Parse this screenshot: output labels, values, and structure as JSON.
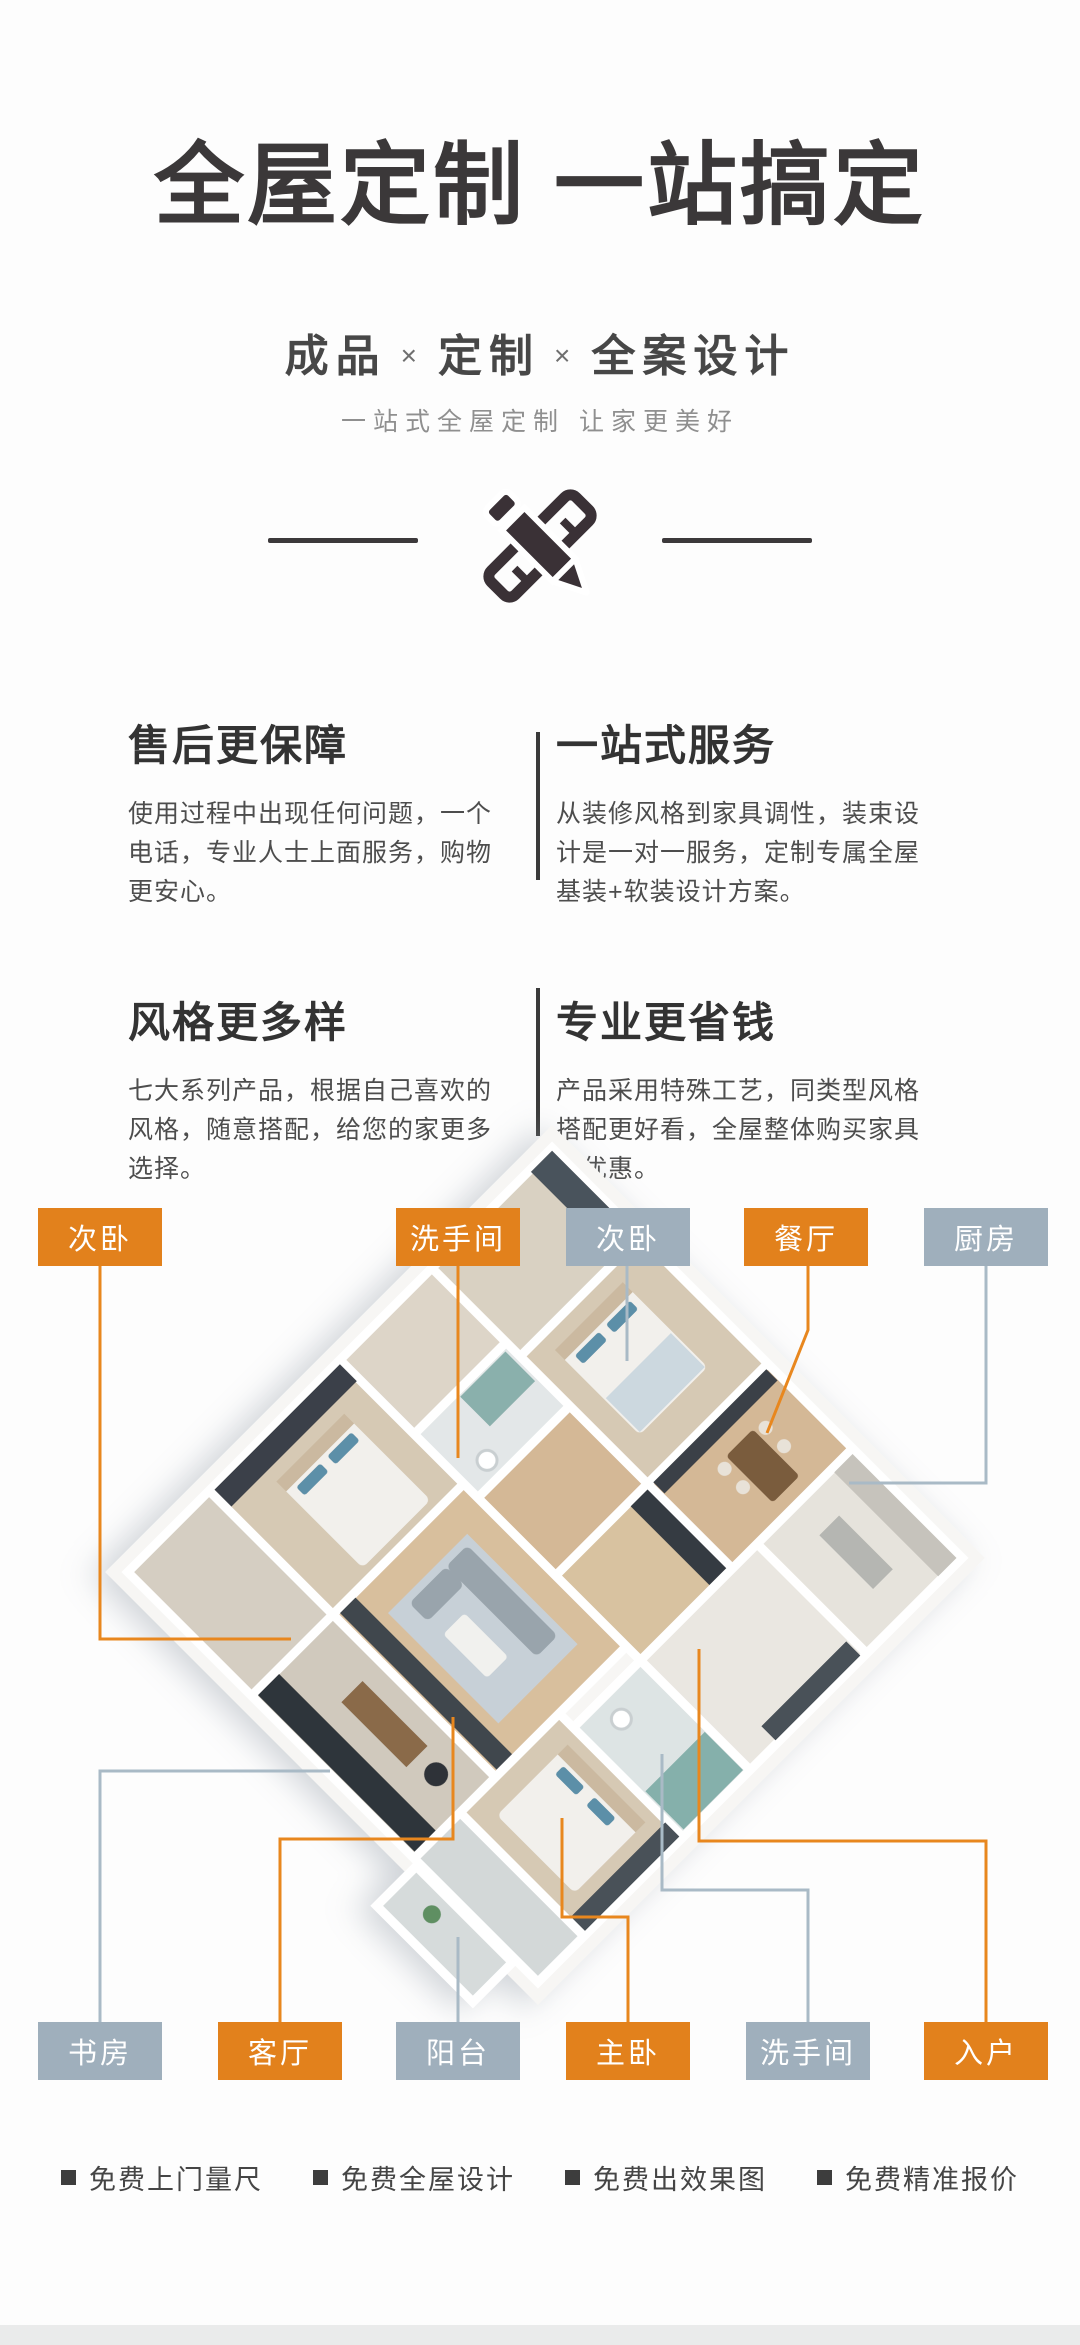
{
  "hero": {
    "title": "全屋定制 一站搞定",
    "subtitle_parts": [
      {
        "t": "成品",
        "k": "word"
      },
      {
        "t": "×",
        "k": "times"
      },
      {
        "t": "定制",
        "k": "word"
      },
      {
        "t": "×",
        "k": "times"
      },
      {
        "t": "全案设计",
        "k": "word"
      }
    ],
    "tagline": "一站式全屋定制 让家更美好",
    "icon": "pencil-ruler-icon"
  },
  "features": [
    {
      "title": "售后更保障",
      "desc": "使用过程中出现任何问题，一个电话，专业人士上面服务，购物更安心。"
    },
    {
      "title": "一站式服务",
      "desc": "从装修风格到家具调性，装束设计是一对一服务，定制专属全屋基装+软装设计方案。"
    },
    {
      "title": "风格更多样",
      "desc": "七大系列产品，根据自己喜欢的风格，随意搭配，给您的家更多选择。"
    },
    {
      "title": "专业更省钱",
      "desc": "产品采用特殊工艺，同类型风格搭配更好看，全屋整体购买家具更优惠。"
    }
  ],
  "floorplan": {
    "colors": {
      "label_orange": "#E2811C",
      "label_gray": "#9FAFBC",
      "line_orange": "#E8871E",
      "line_gray": "#A9BAC6"
    },
    "top_labels": [
      {
        "text": "次卧",
        "color": "orange",
        "x": 38
      },
      {
        "text": "洗手间",
        "color": "orange",
        "x": 396
      },
      {
        "text": "次卧",
        "color": "gray",
        "x": 566
      },
      {
        "text": "餐厅",
        "color": "orange",
        "x": 744
      },
      {
        "text": "厨房",
        "color": "gray",
        "x": 924
      }
    ],
    "bottom_labels": [
      {
        "text": "书房",
        "color": "gray",
        "x": 38
      },
      {
        "text": "客厅",
        "color": "orange",
        "x": 218
      },
      {
        "text": "阳台",
        "color": "gray",
        "x": 396
      },
      {
        "text": "主卧",
        "color": "orange",
        "x": 566
      },
      {
        "text": "洗手间",
        "color": "gray",
        "x": 746
      },
      {
        "text": "入户",
        "color": "orange",
        "x": 924
      }
    ]
  },
  "services": {
    "items": [
      "免费上门量尺",
      "免费全屋设计",
      "免费出效果图",
      "免费精准报价"
    ]
  }
}
